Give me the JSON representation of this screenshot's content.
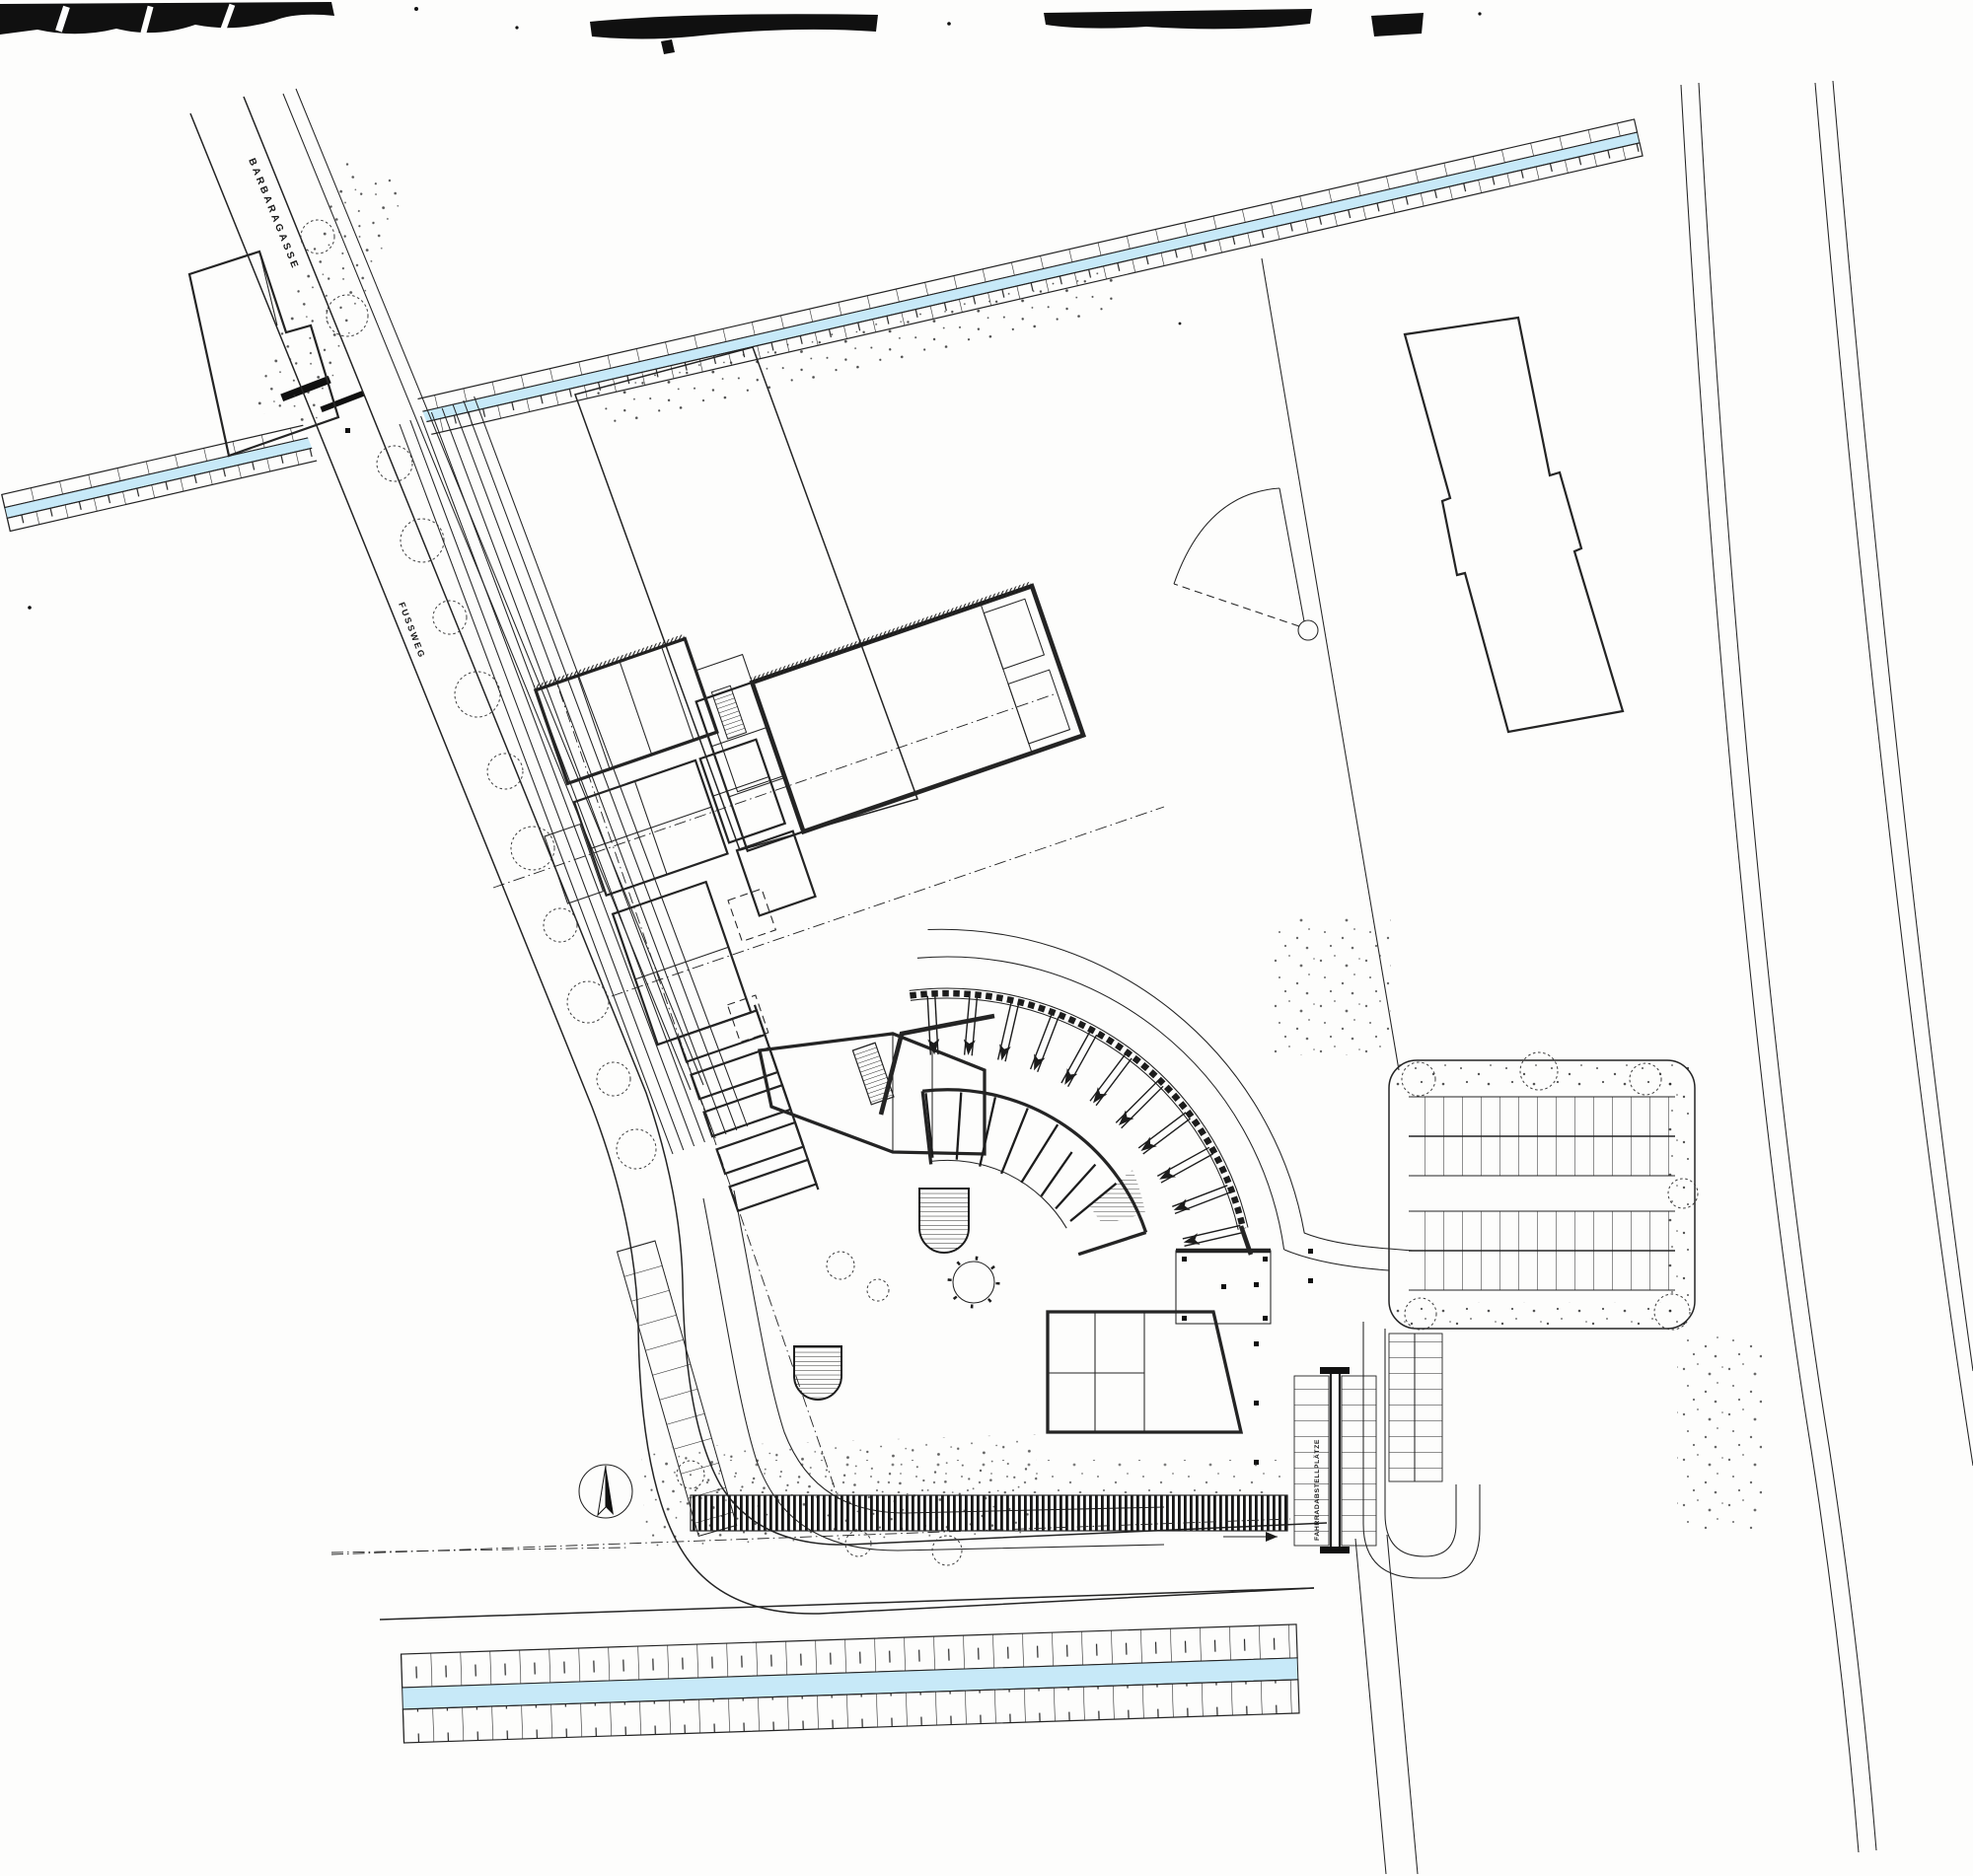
{
  "drawing": {
    "kind": "site-plan scan",
    "labels": {
      "street": "BARBARAGASSE",
      "footpath": "FUSSWEG",
      "bike_parking": "FAHRRADABSTELLPLÄTZE"
    },
    "colors": {
      "water": "#c7e9f8",
      "ink": "#1c1c1c",
      "paper": "#fdfdfc"
    }
  }
}
